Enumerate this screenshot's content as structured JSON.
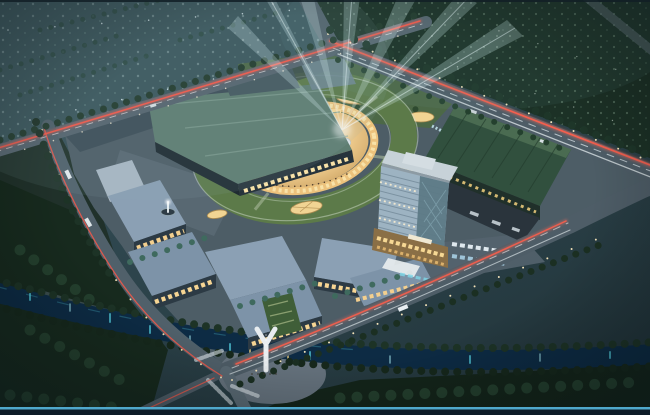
{
  "scene": {
    "description": "Night-time aerial architectural rendering of a mixed-use shopping mall complex: an oval central courtyard with searchlight beams, green roof terraces, a glass office tower, a long exhibition hall with a dark green roof, warm-lit retail blocks, tree-lined arterial roads with light trails, and a reflective canal with a white footbridge in the foreground."
  },
  "palette": {
    "parkland": "#3a565c",
    "forest": "#1c3126",
    "lawn_dark": "#172a1e",
    "lawn_dark2": "#14251a",
    "platform": "#4d5d66",
    "road": "#4e5d67",
    "road_light": "#55646e",
    "marking": "#cfdade",
    "tail_light_red": "#ff5847",
    "head_light_white": "#edf5f7",
    "street_light": "#ffecc0",
    "canal_water": "#0d2b44",
    "water_reflection": "#57d8e8",
    "cinema_roof": "#5e7d71",
    "hall_roof": "#31503e",
    "terrace_green": "#5c7a49",
    "north_lawn": "#4c6847",
    "facade_warm": "#ecc27c",
    "window_warm": "#f8e2a8",
    "retail_roof": "#8ba0b4",
    "tower_glass": "#9db3c2",
    "tower_glass_dark": "#5d7a86",
    "tower_roof": "#c7d2d8",
    "canopy_white": "#edf0f2",
    "beam_light": "#cfeef2",
    "frame_line": "#4fa8cc",
    "frame_bar": "#0d1b27"
  }
}
